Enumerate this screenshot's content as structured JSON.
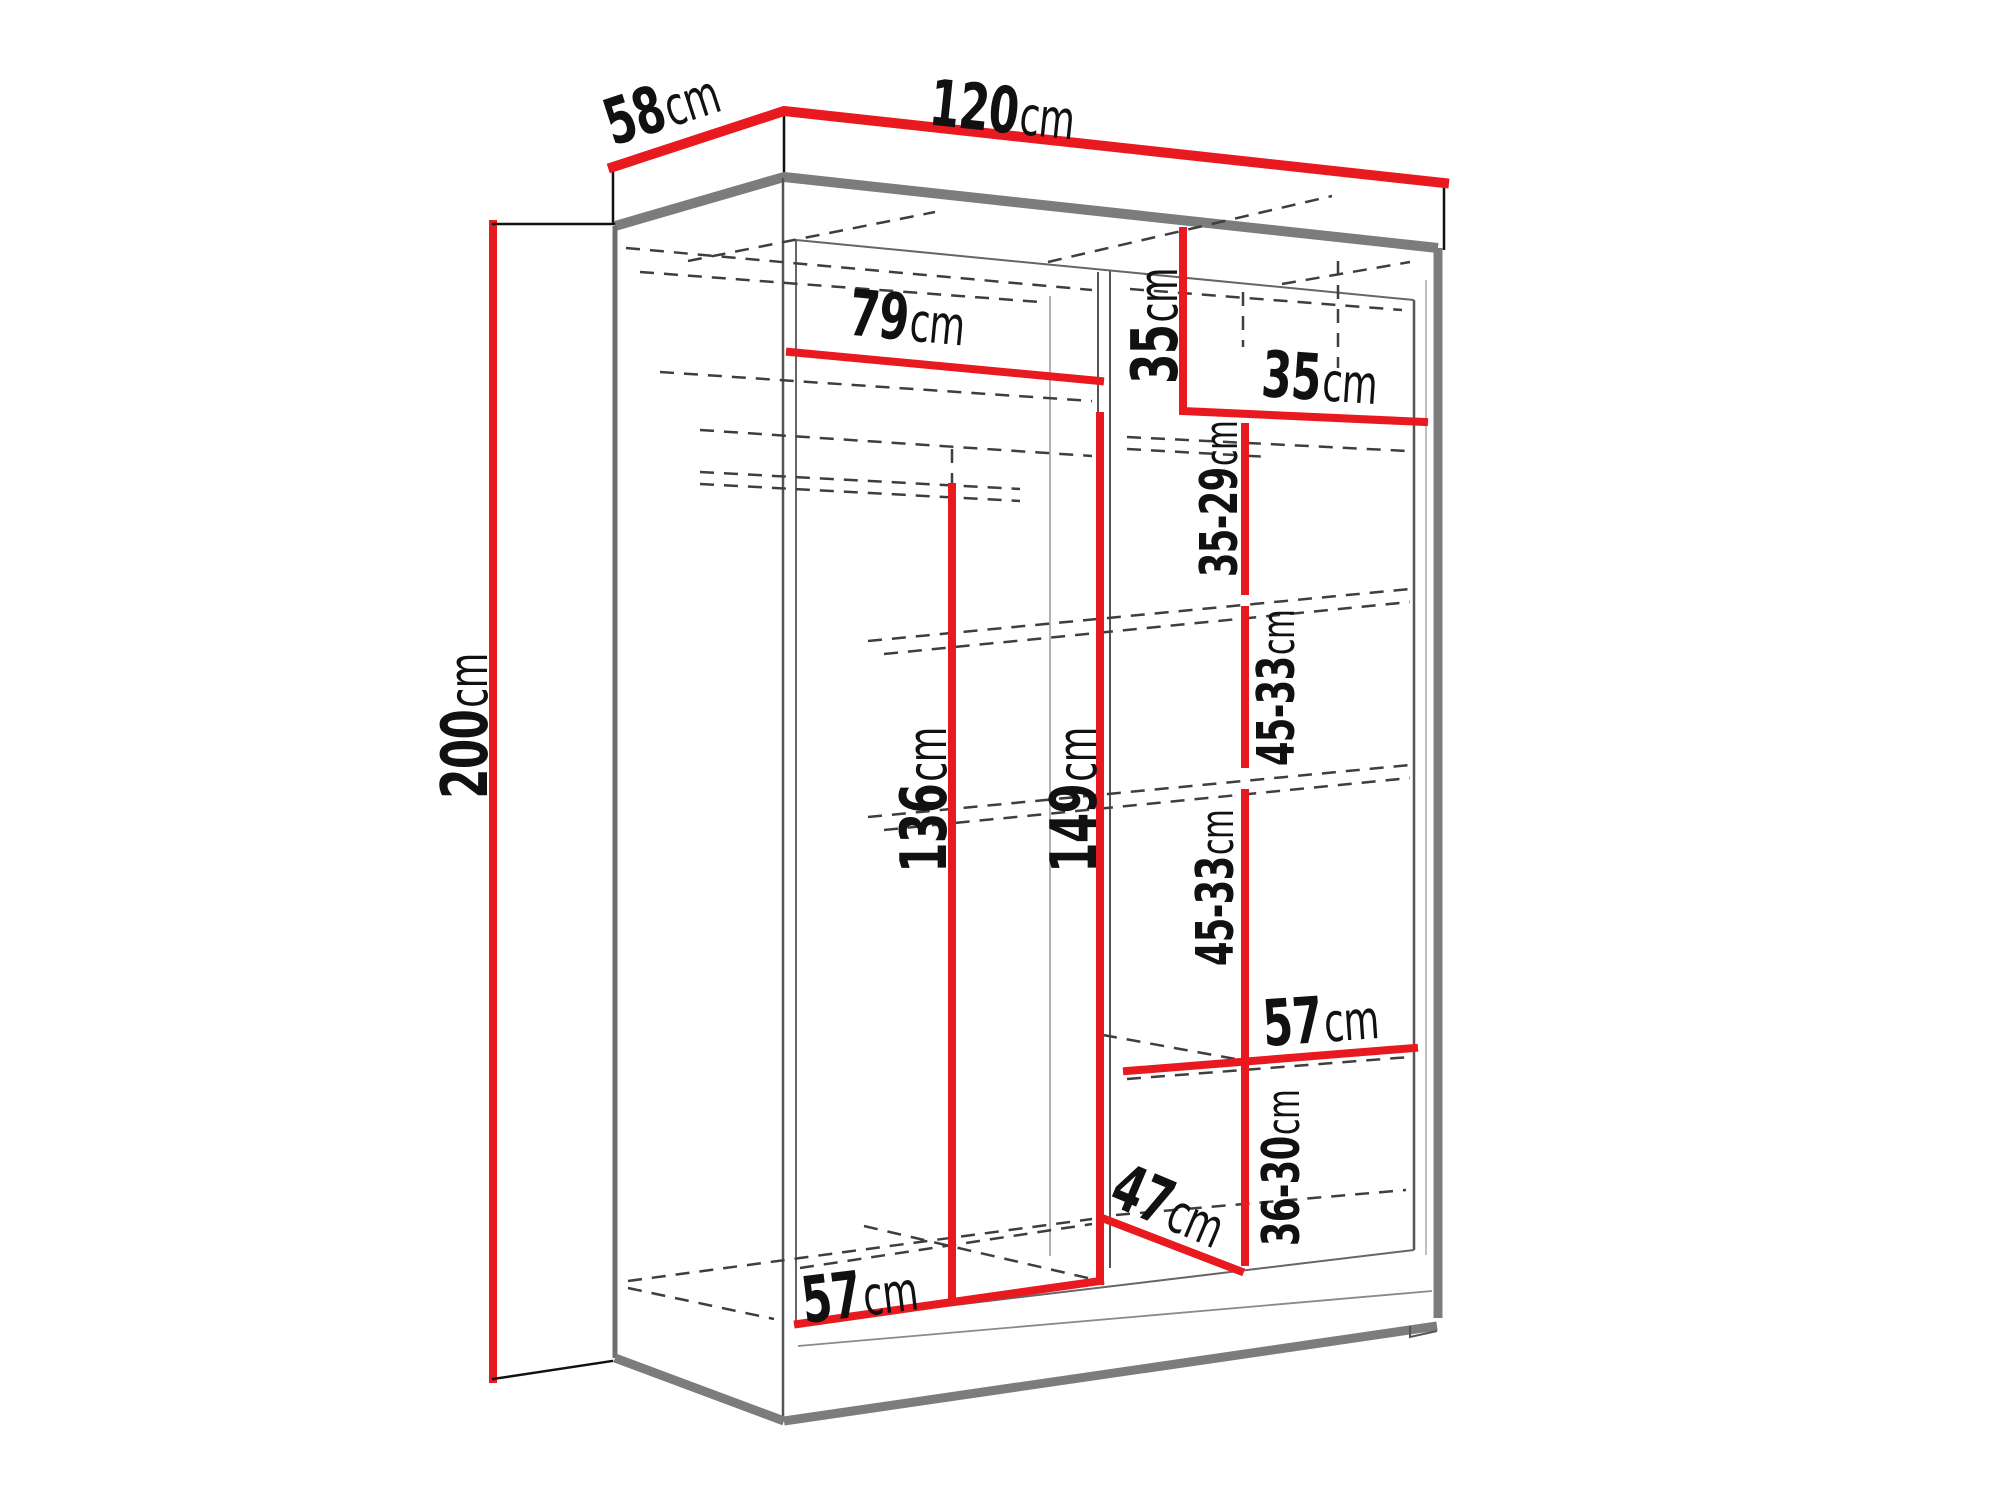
{
  "diagram": {
    "type": "wardrobe-dimension-drawing",
    "unit": "cm",
    "colors": {
      "dimension_line": "#e8191f",
      "edge_gray": "#7c7c7c",
      "line_dark": "#111111",
      "dashed_interior": "#3e3e3e",
      "background": "#ffffff"
    },
    "dims": {
      "depth_top": {
        "num": "58",
        "unit": "cm"
      },
      "width_top": {
        "num": "120",
        "unit": "cm"
      },
      "height_left": {
        "num": "200",
        "unit": "cm"
      },
      "inner_width_left": {
        "num": "79",
        "unit": "cm"
      },
      "top_section_height": {
        "num": "35",
        "unit": "cm"
      },
      "top_section_width": {
        "num": "35",
        "unit": "cm"
      },
      "shelf_gap_1": {
        "num": "35-29",
        "unit": "cm"
      },
      "shelf_gap_2": {
        "num": "45-33",
        "unit": "cm"
      },
      "shelf_gap_3": {
        "num": "45-33",
        "unit": "cm"
      },
      "inner_height_left": {
        "num": "136",
        "unit": "cm"
      },
      "inner_height_mid": {
        "num": "149",
        "unit": "cm"
      },
      "shelf_width_right": {
        "num": "57",
        "unit": "cm"
      },
      "shelf_gap_4": {
        "num": "36-30",
        "unit": "cm"
      },
      "bottom_depth": {
        "num": "47",
        "unit": "cm"
      },
      "bottom_width": {
        "num": "57",
        "unit": "cm"
      }
    }
  }
}
